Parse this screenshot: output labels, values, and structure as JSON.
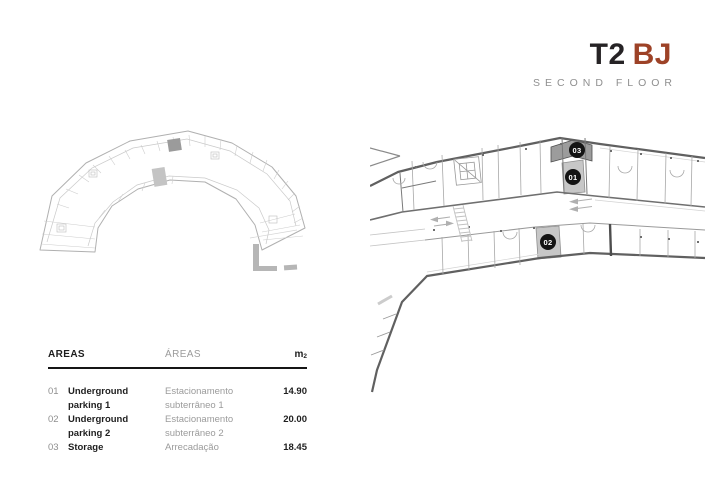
{
  "theme": {
    "accent_color": "#9d4227",
    "heading_color": "#262325",
    "muted_color": "#8f8f8f",
    "highlight_dark": "#9c9c9c",
    "highlight_light": "#c7c7c7",
    "badge_bg": "#141414"
  },
  "title": {
    "primary": "T2",
    "accent": "BJ",
    "subtitle": "SECOND FLOOR"
  },
  "plans": {
    "markers": [
      {
        "label": "01"
      },
      {
        "label": "02"
      },
      {
        "label": "03"
      }
    ]
  },
  "table": {
    "header": {
      "en": "AREAS",
      "pt": "ÁREAS",
      "unit": "m",
      "unit_sub": "2"
    },
    "rows": [
      {
        "num": "01",
        "en": "Underground parking 1",
        "pt": "Estacionamento subterrâneo 1",
        "area": "14.90"
      },
      {
        "num": "02",
        "en": "Underground parking 2",
        "pt": "Estacionamento subterrâneo 2",
        "area": "20.00"
      },
      {
        "num": "03",
        "en": "Storage",
        "pt": "Arrecadação",
        "area": "18.45"
      }
    ]
  }
}
